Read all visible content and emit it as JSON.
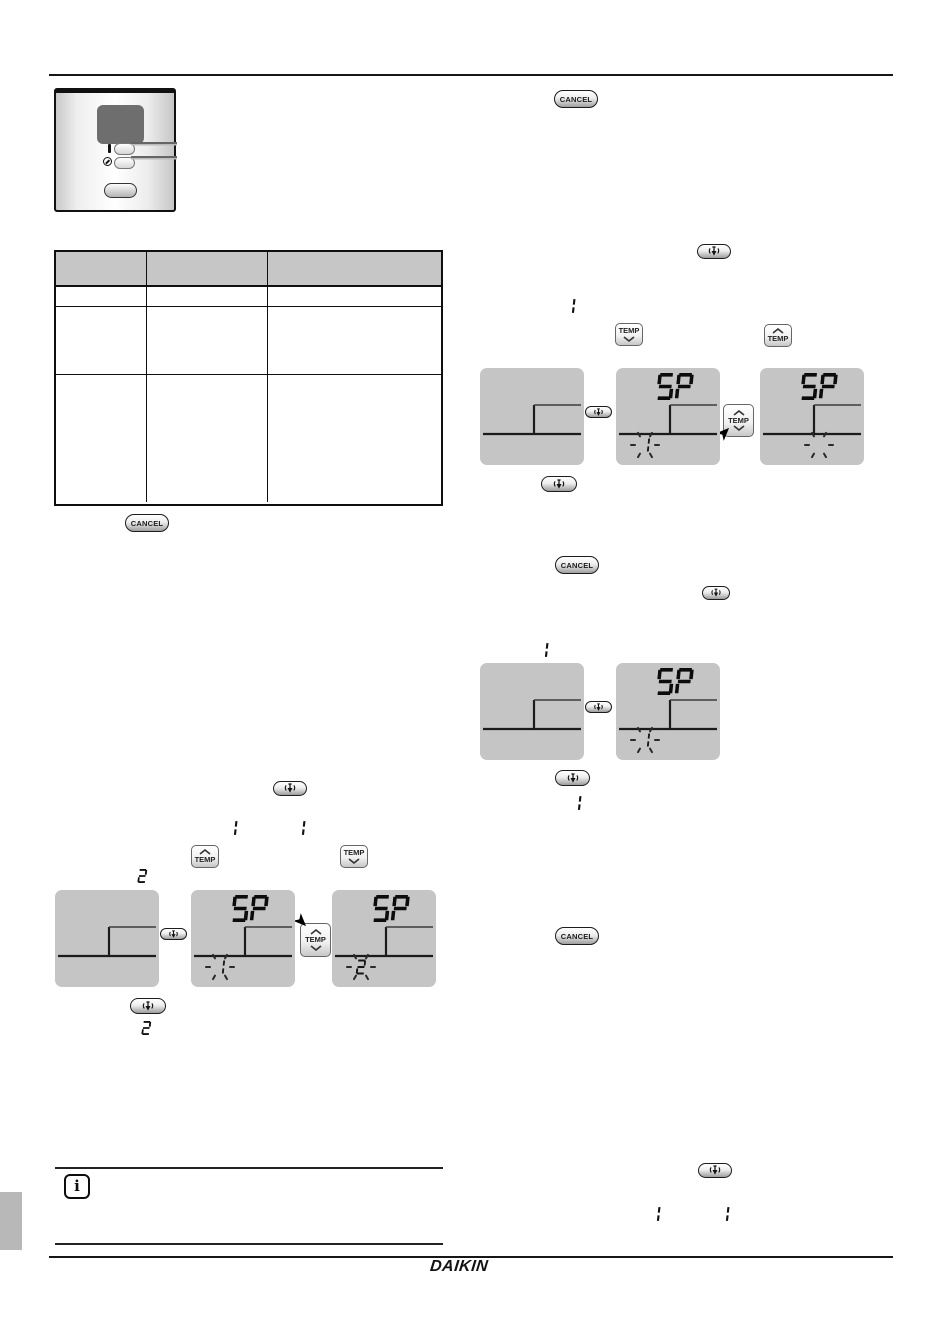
{
  "document": {
    "brand": "DAIKIN",
    "buttons": {
      "cancel": "CANCEL",
      "temp": "TEMP"
    },
    "display": {
      "setpoint_label": "SP"
    },
    "digits": {
      "one": "1",
      "two": "2"
    },
    "controller": {
      "on_marker": "I"
    },
    "note": {
      "icon_letter": "i"
    },
    "colors": {
      "table_header": "#c6c6c6",
      "lcd_background": "#c5c5c5",
      "page_marker": "#b8b8b8",
      "ink": "#141414"
    },
    "lcds": [
      {
        "sp": "",
        "blink": null
      },
      {
        "sp": "SP",
        "blink": "1"
      },
      {
        "sp": "SP",
        "blink": "2"
      },
      {
        "sp": "",
        "blink": null
      },
      {
        "sp": "SP",
        "blink": "1"
      },
      {
        "sp": "SP",
        "blink": ""
      },
      {
        "sp": "",
        "blink": null
      },
      {
        "sp": "SP",
        "blink": "1"
      }
    ]
  }
}
